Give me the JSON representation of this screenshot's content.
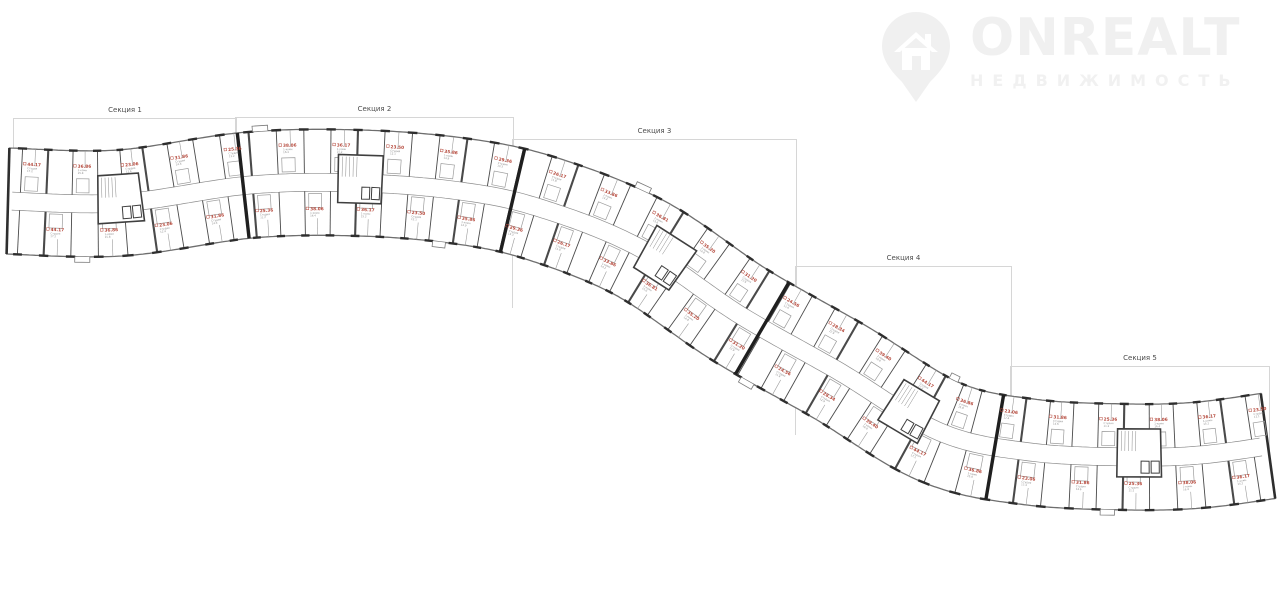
{
  "logo": {
    "brand": "ONREALT",
    "subtitle": "НЕДВИЖИМОСТЬ"
  },
  "sections": [
    {
      "label": "Секция 1",
      "box": {
        "x": 13,
        "y": 118,
        "w": 222,
        "h": 110
      }
    },
    {
      "label": "Секция 2",
      "box": {
        "x": 235,
        "y": 117,
        "w": 277,
        "h": 112
      }
    },
    {
      "label": "Секция 3",
      "box": {
        "x": 512,
        "y": 139,
        "w": 283,
        "h": 168
      }
    },
    {
      "label": "Секция 4",
      "box": {
        "x": 795,
        "y": 266,
        "w": 215,
        "h": 168
      }
    },
    {
      "label": "Секция 5",
      "box": {
        "x": 1010,
        "y": 366,
        "w": 258,
        "h": 118
      }
    }
  ],
  "plan": {
    "centerline": [
      [
        8,
        201
      ],
      [
        120,
        203
      ],
      [
        250,
        185
      ],
      [
        360,
        183
      ],
      [
        460,
        191
      ],
      [
        540,
        208
      ],
      [
        640,
        248
      ],
      [
        740,
        315
      ],
      [
        840,
        372
      ],
      [
        940,
        432
      ],
      [
        1030,
        452
      ],
      [
        1130,
        457
      ],
      [
        1200,
        455
      ],
      [
        1268,
        446
      ]
    ],
    "half_width": 53,
    "corridor_half_width": 9,
    "unit_spacing": 26,
    "section_walls_x": [
      238,
      512,
      760,
      992
    ],
    "core_centers_x": [
      116,
      360,
      662,
      902,
      1139
    ],
    "units": [
      {
        "area": "44.17",
        "type": "Студия",
        "detail": "17.2"
      },
      {
        "area": "36.86",
        "type": "1-комн",
        "detail": "15.8"
      },
      {
        "area": "23.06",
        "type": "Студия",
        "detail": "12.4"
      },
      {
        "area": "31.86",
        "type": "Студия",
        "detail": "14.6"
      },
      {
        "area": "25.36",
        "type": "Студия",
        "detail": "11.2"
      },
      {
        "area": "38.06",
        "type": "1-комн",
        "detail": "16.4"
      },
      {
        "area": "36.17",
        "type": "1-комн",
        "detail": "15.2"
      },
      {
        "area": "23.50",
        "type": "Студия",
        "detail": "12.1"
      },
      {
        "area": "35.86",
        "type": "1-комн",
        "detail": "14.9"
      },
      {
        "area": "29.36",
        "type": "Студия",
        "detail": "13.3"
      },
      {
        "area": "26.17",
        "type": "Студия",
        "detail": "11.8"
      },
      {
        "area": "33.86",
        "type": "1-комн",
        "detail": "14.2"
      },
      {
        "area": "36.81",
        "type": "1-комн",
        "detail": "15.6"
      },
      {
        "area": "35.20",
        "type": "1-комн",
        "detail": "14.8"
      },
      {
        "area": "31.20",
        "type": "Студия",
        "detail": "13.9"
      },
      {
        "area": "24.56",
        "type": "Студия",
        "detail": "11.6"
      },
      {
        "area": "28.34",
        "type": "Студия",
        "detail": "12.9"
      },
      {
        "area": "39.40",
        "type": "1-комн",
        "detail": "16.8"
      }
    ],
    "colors": {
      "outline": "#6e6e6e",
      "wall_bold": "#2e2e2e",
      "wall": "#4a4a4a",
      "thin": "#9c9c9c",
      "corridor": "#8d8d8d",
      "label_red": "#b5483b",
      "label_gray": "#8a8a8a",
      "box_border": "#d6d6d6",
      "watermark": "#f0f0f0"
    }
  }
}
